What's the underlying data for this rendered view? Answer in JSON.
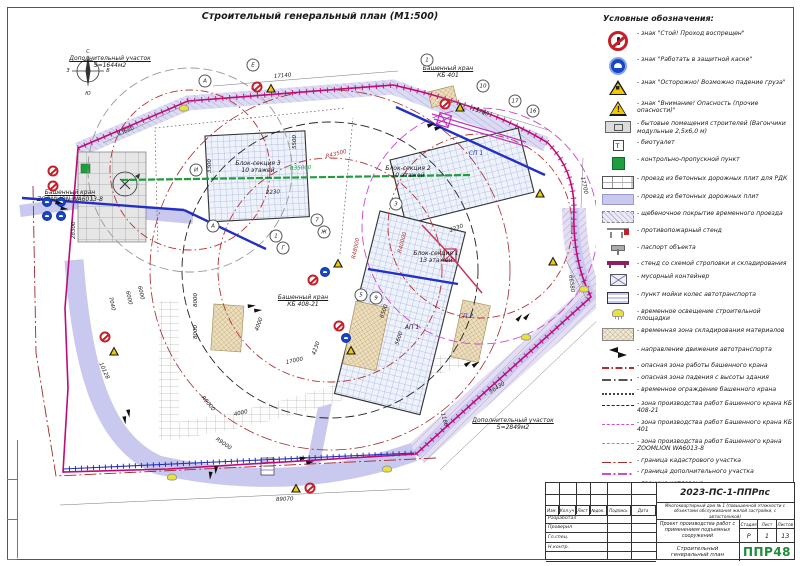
{
  "page": {
    "title": "Строительный генеральный план (М1:500)"
  },
  "colors": {
    "boundary_magenta": "#c00a78",
    "danger_red": "#b53333",
    "road_lavender": "#c9c9ef",
    "fence_blue": "#2233bb",
    "kpp_green": "#1e9e3e",
    "logo_green": "#1e8c3c"
  },
  "legend": {
    "title": "Условные обозначения:",
    "items": [
      {
        "icon": "sign-stop",
        "text": "- знак \"Стой! Проход воспрещен\""
      },
      {
        "icon": "sign-helmet",
        "text": "- знак \"Работать в защитной каске\""
      },
      {
        "icon": "sign-load",
        "text": "- знак \"Осторожно! Возможно падение груза\""
      },
      {
        "icon": "sign-danger",
        "text": "- знак \"Внимание! Опасность (прочие опасности)\""
      },
      {
        "icon": "cabin",
        "text": "- бытовые помещения строителей (Вагончики модульные 2,5х6,0 м)"
      },
      {
        "icon": "wc",
        "text": "- биотуалет"
      },
      {
        "icon": "kpp",
        "text": "- контрольно-пропускной пункт"
      },
      {
        "icon": "road-rdk",
        "text": "- проезд из бетонных дорожных плит для РДК"
      },
      {
        "icon": "road-plates",
        "text": "- проезд из бетонных дорожных плит"
      },
      {
        "icon": "road-gravel",
        "text": "- щебеночное покрытие временного проезда"
      },
      {
        "icon": "fire-stand",
        "text": "- противопожарный стенд"
      },
      {
        "icon": "passport",
        "text": "- паспорт объекта"
      },
      {
        "icon": "sling-stand",
        "text": "- стенд со схемой строповки и складирования"
      },
      {
        "icon": "trash",
        "text": "- мусорный контейнер"
      },
      {
        "icon": "wheel-wash",
        "text": "- пункт мойки колес автотранспорта"
      },
      {
        "icon": "lamp",
        "text": "- временное освещение строительной площадки"
      },
      {
        "icon": "storage",
        "text": "- временная зона складирования материалов"
      },
      {
        "icon": "arrows",
        "text": "- направление движения автотранспорта"
      },
      {
        "icon": "line-danger-crane",
        "text": "- опасная зона работы башенного крана"
      },
      {
        "icon": "line-danger-fall",
        "text": "- опасная зона падения с высоты здания"
      },
      {
        "icon": "line-crane-fence",
        "text": "- временное ограждение башенного крана"
      },
      {
        "icon": "line-zone-kb408",
        "text": "- зона производства работ Башенного крана КБ 408-21"
      },
      {
        "icon": "line-zone-kb401",
        "text": "- зона производства работ Башенного крана КБ 401"
      },
      {
        "icon": "line-zone-zoomlion",
        "text": "- зона производства работ Башенного крана ZOOMLION WA6013-8"
      },
      {
        "icon": "line-cadastre",
        "text": "- граница кадастрового участка"
      },
      {
        "icon": "line-addplot",
        "text": "- граница дополнительного участка"
      },
      {
        "icon": "line-pit",
        "text": "- граница котлована"
      },
      {
        "icon": "line-water",
        "text": "- проектируемый водопровод"
      },
      {
        "icon": "line-fence-gost",
        "text": "- временное ограждение стройплощадки по ГОСТ Р 58967-2020"
      }
    ]
  },
  "plan": {
    "labels": [
      {
        "x": 102,
        "y": 48,
        "u": true,
        "lines": [
          "Дополнительный участок",
          "S=1644м2"
        ]
      },
      {
        "x": 505,
        "y": 410,
        "u": true,
        "lines": [
          "Дополнительный участок",
          "S=2849м2"
        ]
      },
      {
        "x": 440,
        "y": 58,
        "u": true,
        "lines": [
          "Башенный кран",
          "КБ 401"
        ]
      },
      {
        "x": 62,
        "y": 182,
        "u": true,
        "lines": [
          "Башенный кран",
          "ZOOMLION WA6013-8"
        ]
      },
      {
        "x": 295,
        "y": 287,
        "u": true,
        "lines": [
          "Башенный кран",
          "КБ 408-21"
        ]
      },
      {
        "x": 250,
        "y": 153,
        "lines": [
          "Блок-секция 3",
          "10 этажей"
        ]
      },
      {
        "x": 400,
        "y": 158,
        "lines": [
          "Блок-секция 2",
          "10 этажей"
        ]
      },
      {
        "x": 428,
        "y": 243,
        "lines": [
          "Блок-секция 1",
          "13 этажей"
        ]
      },
      {
        "x": 404,
        "y": 317,
        "lines": [
          "АП 1"
        ]
      },
      {
        "x": 468,
        "y": 143,
        "cls": "blue",
        "lines": [
          "СП 1"
        ]
      },
      {
        "x": 458,
        "y": 306,
        "cls": "blue",
        "lines": [
          "СП 2"
        ]
      },
      {
        "x": 80,
        "y": 42,
        "cls": "tiny",
        "lines": [
          "С"
        ]
      },
      {
        "x": 80,
        "y": 84,
        "cls": "tiny",
        "lines": [
          "Ю"
        ]
      },
      {
        "x": 60,
        "y": 61,
        "cls": "tiny",
        "lines": [
          "З"
        ]
      },
      {
        "x": 100,
        "y": 61,
        "cls": "tiny",
        "lines": [
          "В"
        ]
      }
    ],
    "dimensions": [
      {
        "x": 110,
        "y": 124,
        "rot": -23,
        "t": "43660"
      },
      {
        "x": 266,
        "y": 66,
        "rot": -5,
        "t": "17140"
      },
      {
        "x": 464,
        "y": 98,
        "rot": 20,
        "t": "15780"
      },
      {
        "x": 574,
        "y": 166,
        "rot": 78,
        "t": "17700"
      },
      {
        "x": 562,
        "y": 264,
        "rot": 83,
        "t": "66580"
      },
      {
        "x": 482,
        "y": 382,
        "rot": -33,
        "t": "56430"
      },
      {
        "x": 268,
        "y": 489,
        "rot": -2,
        "t": "89070"
      },
      {
        "x": 66,
        "y": 228,
        "rot": -90,
        "t": "28300"
      },
      {
        "x": 92,
        "y": 352,
        "rot": 65,
        "t": "10128"
      },
      {
        "x": 102,
        "y": 286,
        "rot": 78,
        "t": "7040"
      },
      {
        "x": 119,
        "y": 280,
        "rot": 78,
        "t": "6000"
      },
      {
        "x": 131,
        "y": 275,
        "rot": 78,
        "t": "6000"
      },
      {
        "x": 188,
        "y": 296,
        "rot": -90,
        "t": "8000"
      },
      {
        "x": 188,
        "y": 328,
        "rot": -90,
        "t": "8000"
      },
      {
        "x": 194,
        "y": 386,
        "rot": 50,
        "t": "R9000"
      },
      {
        "x": 208,
        "y": 428,
        "rot": 35,
        "t": "R9000"
      },
      {
        "x": 249,
        "y": 320,
        "rot": -70,
        "t": "4000"
      },
      {
        "x": 226,
        "y": 404,
        "rot": -12,
        "t": "4000"
      },
      {
        "x": 278,
        "y": 352,
        "rot": -12,
        "t": "17000"
      },
      {
        "x": 306,
        "y": 344,
        "rot": -70,
        "t": "4230"
      },
      {
        "x": 374,
        "y": 307,
        "rot": -70,
        "t": "6500"
      },
      {
        "x": 389,
        "y": 334,
        "rot": -70,
        "t": "5600"
      },
      {
        "x": 258,
        "y": 182,
        "rot": -3,
        "t": "2230"
      },
      {
        "x": 442,
        "y": 220,
        "rot": -20,
        "t": "2230"
      },
      {
        "x": 202,
        "y": 162,
        "rot": -90,
        "t": "3300"
      },
      {
        "x": 287,
        "y": 138,
        "rot": -90,
        "t": "5500"
      },
      {
        "x": 434,
        "y": 402,
        "rot": 75,
        "t": "1180"
      },
      {
        "x": 282,
        "y": 158,
        "rot": -3,
        "cls": "green",
        "t": "R35000"
      },
      {
        "x": 318,
        "y": 146,
        "rot": -14,
        "cls": "red",
        "t": "R43500"
      },
      {
        "x": 346,
        "y": 248,
        "rot": -78,
        "cls": "red",
        "t": "R48000"
      },
      {
        "x": 392,
        "y": 242,
        "rot": -75,
        "cls": "red",
        "t": "R40000"
      }
    ],
    "bubbles": [
      {
        "x": 197,
        "y": 73,
        "t": "А"
      },
      {
        "x": 245,
        "y": 57,
        "t": "Е"
      },
      {
        "x": 419,
        "y": 52,
        "t": "1"
      },
      {
        "x": 475,
        "y": 78,
        "t": "10"
      },
      {
        "x": 507,
        "y": 93,
        "t": "17"
      },
      {
        "x": 525,
        "y": 103,
        "t": "16"
      },
      {
        "x": 188,
        "y": 162,
        "t": "И"
      },
      {
        "x": 205,
        "y": 218,
        "t": "А"
      },
      {
        "x": 275,
        "y": 240,
        "t": "Г"
      },
      {
        "x": 268,
        "y": 228,
        "t": "1"
      },
      {
        "x": 316,
        "y": 224,
        "t": "Ж"
      },
      {
        "x": 309,
        "y": 212,
        "t": "7"
      },
      {
        "x": 388,
        "y": 196,
        "t": "3"
      },
      {
        "x": 368,
        "y": 290,
        "t": "9"
      },
      {
        "x": 353,
        "y": 287,
        "t": "5"
      }
    ],
    "signs": [
      {
        "x": 45,
        "y": 163,
        "t": "r"
      },
      {
        "x": 45,
        "y": 178,
        "t": "r"
      },
      {
        "x": 39,
        "y": 194,
        "t": "b"
      },
      {
        "x": 53,
        "y": 194,
        "t": "b"
      },
      {
        "x": 39,
        "y": 208,
        "t": "b"
      },
      {
        "x": 53,
        "y": 208,
        "t": "b"
      },
      {
        "x": 249,
        "y": 79,
        "t": "r"
      },
      {
        "x": 263,
        "y": 80,
        "t": "y"
      },
      {
        "x": 437,
        "y": 96,
        "t": "r"
      },
      {
        "x": 452,
        "y": 99,
        "t": "y"
      },
      {
        "x": 532,
        "y": 185,
        "t": "y"
      },
      {
        "x": 545,
        "y": 253,
        "t": "y"
      },
      {
        "x": 305,
        "y": 272,
        "t": "r"
      },
      {
        "x": 317,
        "y": 264,
        "t": "b"
      },
      {
        "x": 330,
        "y": 255,
        "t": "y"
      },
      {
        "x": 331,
        "y": 318,
        "t": "r"
      },
      {
        "x": 338,
        "y": 330,
        "t": "b"
      },
      {
        "x": 343,
        "y": 342,
        "t": "y"
      },
      {
        "x": 288,
        "y": 480,
        "t": "y"
      },
      {
        "x": 302,
        "y": 480,
        "t": "r"
      },
      {
        "x": 97,
        "y": 329,
        "t": "r"
      },
      {
        "x": 106,
        "y": 343,
        "t": "y"
      }
    ],
    "lamps": [
      {
        "x": 164,
        "y": 469
      },
      {
        "x": 379,
        "y": 461
      },
      {
        "x": 576,
        "y": 281
      },
      {
        "x": 176,
        "y": 100
      },
      {
        "x": 518,
        "y": 329
      }
    ],
    "arrows": [
      {
        "x": 119,
        "y": 410,
        "rot": 80
      },
      {
        "x": 205,
        "y": 466,
        "rot": 95
      },
      {
        "x": 465,
        "y": 355,
        "rot": -35
      },
      {
        "x": 516,
        "y": 308,
        "rot": -50
      },
      {
        "x": 248,
        "y": 300,
        "rot": -5
      },
      {
        "x": 300,
        "y": 452,
        "rot": -8
      },
      {
        "x": 428,
        "y": 118,
        "rot": -17
      },
      {
        "x": 55,
        "y": 198,
        "rot": 8
      }
    ]
  },
  "titleblock": {
    "doc_number": "2023-ПС-1-ППРпс",
    "project": "Многоквартирный дом № 1 (повышенной этажности с объектами обслуживания жилой застройки, с автостоянкой)",
    "work_title": "Проект производства работ с применением подъемных сооружений",
    "sheet_title": "Строительный генеральный план",
    "stage_label": "Стадия",
    "sheet_label": "Лист",
    "sheets_label": "Листов",
    "stage": "Р",
    "sheet": "1",
    "sheets": "13",
    "logo": "ППР48",
    "header_cols": [
      "Изм.",
      "Кол.уч",
      "Лист",
      "№док.",
      "Подпись",
      "Дата"
    ],
    "roles": [
      "Разработал",
      "Проверил",
      "Гл.спец.",
      "Н.контр.",
      ""
    ]
  }
}
